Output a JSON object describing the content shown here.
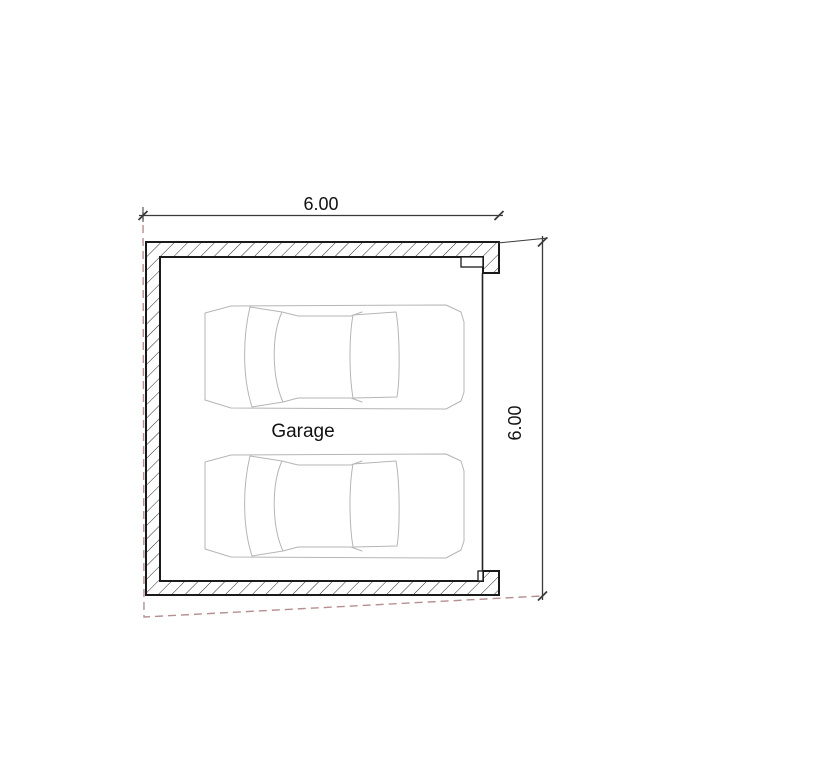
{
  "drawing": {
    "room_label": "Garage",
    "dim_width": "6.00",
    "dim_height": "6.00"
  },
  "colors": {
    "background": "#ffffff",
    "wall_stroke": "#1a1a1a",
    "hatch_stroke": "#2a2a2a",
    "door_stroke": "#222222",
    "car_stroke": "#b5b5b5",
    "dimension_stroke": "#3a3a3a",
    "text": "#111111",
    "dashed_overhang": "#b58f8f"
  }
}
